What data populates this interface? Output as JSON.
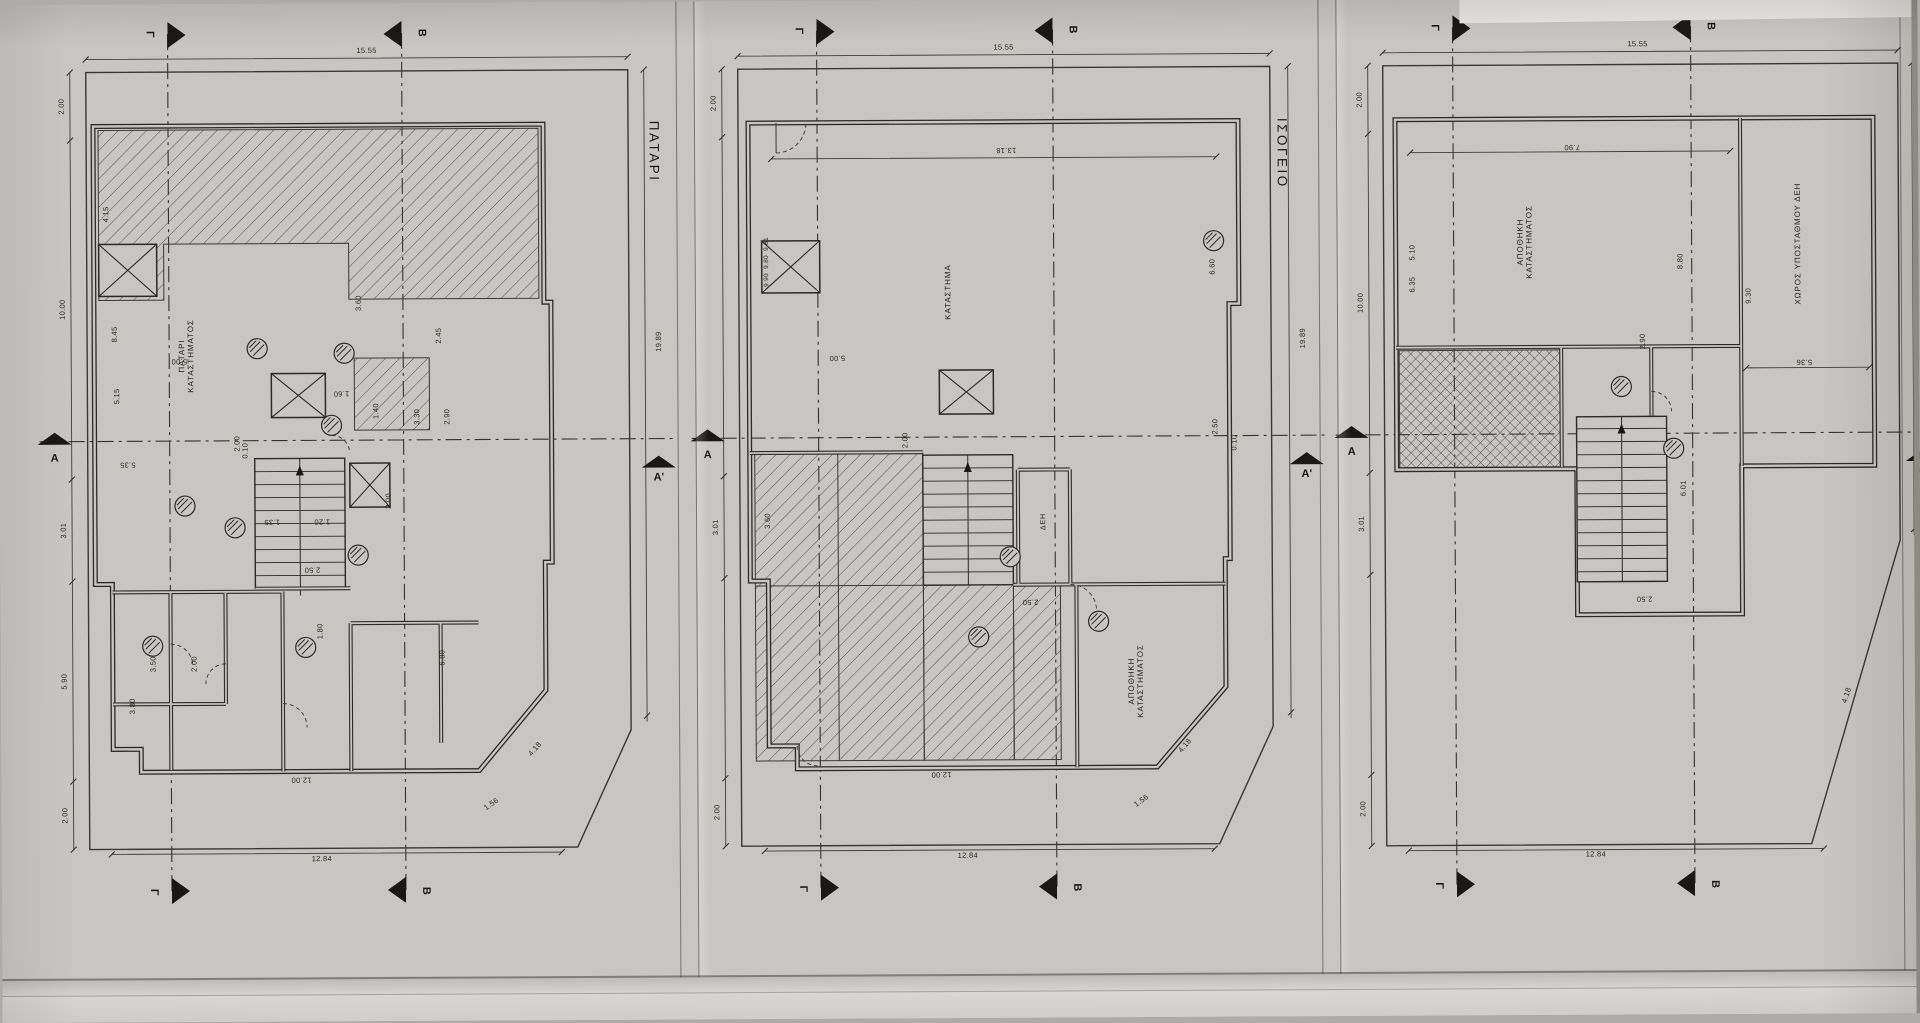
{
  "sheet": {
    "panels": [
      {
        "id": "patari",
        "title": "ΠΑΤΑΡΙ",
        "marker_letters": [
          {
            "t": "Γ",
            "x": 132,
            "y": 30,
            "r": 90
          },
          {
            "t": "Β",
            "x": 404,
            "y": 30,
            "r": 90
          },
          {
            "t": "Γ",
            "x": 132,
            "y": 888,
            "r": 90
          },
          {
            "t": "Β",
            "x": 404,
            "y": 888,
            "r": 90
          },
          {
            "t": "Α",
            "x": 35,
            "y": 454,
            "r": 0
          },
          {
            "t": "Α'",
            "x": 639,
            "y": 476,
            "r": 0
          }
        ],
        "room_labels": [
          {
            "text": "ΠΑΤΑΡΙ\nΚΑΤΑΣΤΗΜΑΤΟΣ",
            "x": 168,
            "y": 352,
            "r": -90
          }
        ],
        "dim_labels": [
          {
            "t": "15.55",
            "x": 349,
            "y": 48,
            "r": 0
          },
          {
            "t": "12.84",
            "x": 300,
            "y": 856,
            "r": 0
          },
          {
            "t": "19.89",
            "x": 640,
            "y": 340,
            "r": -90
          },
          {
            "t": "2.00",
            "x": 44,
            "y": 102,
            "r": -90
          },
          {
            "t": "10.00",
            "x": 44,
            "y": 305,
            "r": -90
          },
          {
            "t": "3.01",
            "x": 44,
            "y": 526,
            "r": -90
          },
          {
            "t": "5.90",
            "x": 44,
            "y": 677,
            "r": -90
          },
          {
            "t": "2.00",
            "x": 44,
            "y": 811,
            "r": -90
          },
          {
            "t": "8.45",
            "x": 96,
            "y": 330,
            "r": -90
          },
          {
            "t": "5.15",
            "x": 98,
            "y": 392,
            "r": -90
          },
          {
            "t": "4.15",
            "x": 88,
            "y": 210,
            "r": -90
          },
          {
            "t": "5.00",
            "x": 160,
            "y": 357,
            "r": 180
          },
          {
            "t": "0.10",
            "x": 226,
            "y": 447,
            "r": -90
          },
          {
            "t": "5.35",
            "x": 108,
            "y": 460,
            "r": 180
          },
          {
            "t": "2.45",
            "x": 420,
            "y": 333,
            "r": -90
          },
          {
            "t": "3.30",
            "x": 398,
            "y": 414,
            "r": -90
          },
          {
            "t": "2.90",
            "x": 428,
            "y": 414,
            "r": -90
          },
          {
            "t": "1.60",
            "x": 322,
            "y": 390,
            "r": 180
          },
          {
            "t": "1.40",
            "x": 357,
            "y": 408,
            "r": -90
          },
          {
            "t": "2.00",
            "x": 369,
            "y": 498,
            "r": -90
          },
          {
            "t": "2.50",
            "x": 292,
            "y": 566,
            "r": 180
          },
          {
            "t": "1.20",
            "x": 302,
            "y": 518,
            "r": 180
          },
          {
            "t": "1.35",
            "x": 252,
            "y": 518,
            "r": 180
          },
          {
            "t": "3.60",
            "x": 340,
            "y": 300,
            "r": -90
          },
          {
            "t": "2.00",
            "x": 218,
            "y": 440,
            "r": -90
          },
          {
            "t": "3.50",
            "x": 133,
            "y": 660,
            "r": -90
          },
          {
            "t": "2.00",
            "x": 174,
            "y": 660,
            "r": -90
          },
          {
            "t": "3.80",
            "x": 112,
            "y": 702,
            "r": -90
          },
          {
            "t": "1.80",
            "x": 300,
            "y": 628,
            "r": -90
          },
          {
            "t": "6.80",
            "x": 422,
            "y": 655,
            "r": -90
          },
          {
            "t": "12.00",
            "x": 280,
            "y": 776,
            "r": 180
          },
          {
            "t": "1.56",
            "x": 470,
            "y": 802,
            "r": -35
          },
          {
            "t": "4.18",
            "x": 514,
            "y": 747,
            "r": -50
          }
        ]
      },
      {
        "id": "isogeio",
        "title": "ΙΣΟΓΕΙΟ",
        "marker_letters": [
          {
            "t": "Γ",
            "x": 123,
            "y": 30,
            "r": 90
          },
          {
            "t": "Β",
            "x": 397,
            "y": 30,
            "r": 90
          },
          {
            "t": "Γ",
            "x": 123,
            "y": 888,
            "r": 90
          },
          {
            "t": "Β",
            "x": 397,
            "y": 888,
            "r": 90
          },
          {
            "t": "Α",
            "x": 30,
            "y": 454,
            "r": 0
          },
          {
            "t": "Α'",
            "x": 629,
            "y": 476,
            "r": 0
          }
        ],
        "room_labels": [
          {
            "text": "ΚΑΤΑΣΤΗΜΑ",
            "x": 272,
            "y": 292,
            "r": -90
          },
          {
            "text": "ΔΕΗ",
            "x": 366,
            "y": 522,
            "r": -90,
            "s": 7
          },
          {
            "text": "ΑΠΟΘΗΚΗ\nΚΑΤΑΣΤΗΜΑΤΟΣ",
            "x": 458,
            "y": 682,
            "r": -90
          }
        ],
        "dim_labels": [
          {
            "t": "15.55",
            "x": 328,
            "y": 48,
            "r": 0
          },
          {
            "t": "12.84",
            "x": 288,
            "y": 856,
            "r": 0
          },
          {
            "t": "19.89",
            "x": 626,
            "y": 340,
            "r": -90
          },
          {
            "t": "2.00",
            "x": 38,
            "y": 102,
            "r": -90
          },
          {
            "t": "9.81",
            "x": 90,
            "y": 243,
            "r": -90,
            "s": 6.5
          },
          {
            "t": "9.80",
            "x": 90,
            "y": 261,
            "r": -90,
            "s": 6.5
          },
          {
            "t": "9.90",
            "x": 90,
            "y": 279,
            "r": -90,
            "s": 6.5
          },
          {
            "t": "3.01",
            "x": 38,
            "y": 526,
            "r": -90
          },
          {
            "t": "3.60",
            "x": 90,
            "y": 520,
            "r": -90
          },
          {
            "t": "2.00",
            "x": 38,
            "y": 811,
            "r": -90
          },
          {
            "t": "13.18",
            "x": 330,
            "y": 150,
            "r": 180
          },
          {
            "t": "6.60",
            "x": 536,
            "y": 268,
            "r": -90
          },
          {
            "t": "2.50",
            "x": 538,
            "y": 428,
            "r": -90
          },
          {
            "t": "0.10",
            "x": 557,
            "y": 444,
            "r": -90
          },
          {
            "t": "5.00",
            "x": 160,
            "y": 357,
            "r": 180
          },
          {
            "t": "2.00",
            "x": 228,
            "y": 440,
            "r": -90
          },
          {
            "t": "2.50",
            "x": 352,
            "y": 602,
            "r": 180
          },
          {
            "t": "12.00",
            "x": 262,
            "y": 774,
            "r": 180
          },
          {
            "t": "1.56",
            "x": 462,
            "y": 802,
            "r": -35
          },
          {
            "t": "4.18",
            "x": 506,
            "y": 747,
            "r": -50
          }
        ]
      },
      {
        "id": "third-plan",
        "title": "",
        "marker_letters": [
          {
            "t": "Γ",
            "x": 115,
            "y": 30,
            "r": 90
          },
          {
            "t": "Β",
            "x": 391,
            "y": 30,
            "r": 90
          },
          {
            "t": "Γ",
            "x": 115,
            "y": 888,
            "r": 90
          },
          {
            "t": "Β",
            "x": 391,
            "y": 888,
            "r": 90
          },
          {
            "t": "Α",
            "x": 30,
            "y": 454,
            "r": 0
          },
          {
            "t": "Α'",
            "x": 601,
            "y": 476,
            "r": 0
          }
        ],
        "room_labels": [
          {
            "text": "ΑΠΟΘΗΚΗ\nΚΑΤΑΣΤΗΜΑΤΟΣ",
            "x": 205,
            "y": 245,
            "r": -90
          },
          {
            "text": "ΧΩΡΟΣ ΥΠΟΣΤΑΘΜΟΥ ΔΕΗ",
            "x": 478,
            "y": 248,
            "r": -90
          }
        ],
        "dim_labels": [
          {
            "t": "15.55",
            "x": 318,
            "y": 48,
            "r": 0
          },
          {
            "t": "12.84",
            "x": 272,
            "y": 858,
            "r": 0
          },
          {
            "t": "19.89",
            "x": 606,
            "y": 340,
            "r": -90
          },
          {
            "t": "2.00",
            "x": 40,
            "y": 102,
            "r": -90
          },
          {
            "t": "10.00",
            "x": 40,
            "y": 305,
            "r": -90
          },
          {
            "t": "3.01",
            "x": 40,
            "y": 526,
            "r": -90
          },
          {
            "t": "2.00",
            "x": 40,
            "y": 811,
            "r": -90
          },
          {
            "t": "7.90",
            "x": 252,
            "y": 150,
            "r": 180
          },
          {
            "t": "5.10",
            "x": 92,
            "y": 255,
            "r": -90
          },
          {
            "t": "6.35",
            "x": 92,
            "y": 287,
            "r": -90
          },
          {
            "t": "8.80",
            "x": 360,
            "y": 265,
            "r": -90
          },
          {
            "t": "9.30",
            "x": 428,
            "y": 300,
            "r": -90
          },
          {
            "t": "5.36",
            "x": 483,
            "y": 366,
            "r": 180
          },
          {
            "t": "2.90",
            "x": 322,
            "y": 345,
            "r": -90
          },
          {
            "t": "2.50",
            "x": 322,
            "y": 602,
            "r": 180
          },
          {
            "t": "6.01",
            "x": 362,
            "y": 492,
            "r": -90
          },
          {
            "t": "4.18",
            "x": 524,
            "y": 700,
            "r": -72
          }
        ]
      }
    ]
  }
}
